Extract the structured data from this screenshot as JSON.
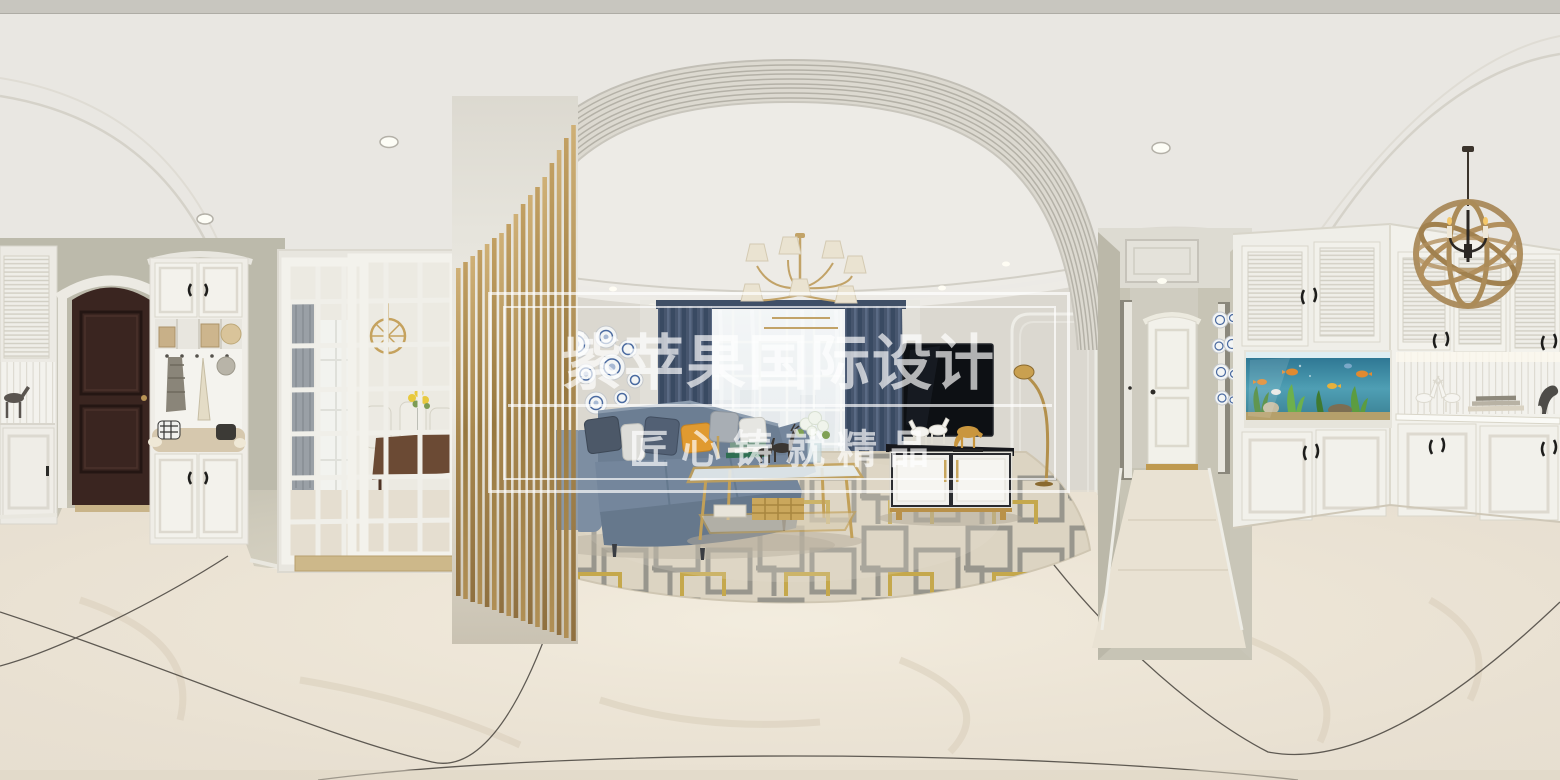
{
  "scene": {
    "type": "equirectangular-360-panorama",
    "subject": "modern apartment interior: entryway with coat cabinet and dark wood door, dining room behind white glass sliding doors, gold slat partition, living room with blue leather sectional sofa, geometric rug, gold coffee table, wall-mounted TV with console and horse figurines, blue curtains, hallway with white doors, built-in white cabinets with aquarium and rope-sphere pendant light"
  },
  "watermark": {
    "title": "紫苹果国际设计",
    "subtitle": "匠心铸就精品"
  },
  "palette": {
    "ceiling": "#e9e7e2",
    "wall_green_gray": "#bfbdae",
    "living_wall": "#dbd8d0",
    "floor": "#e7dfd1",
    "gold": "#b5915a",
    "sofa_blue": "#74869c",
    "curtain_blue": "#47566e",
    "pillow_orange": "#e09a30",
    "door_brown": "#3a2520",
    "rug_base": "#dcd4c2",
    "rug_gray": "#8f8e86",
    "rug_yellow": "#c2a23c",
    "tv_black": "#0d1014",
    "aquarium_water": "#3a84a0",
    "watermark_white": "rgba(255,255,255,0.68)"
  }
}
